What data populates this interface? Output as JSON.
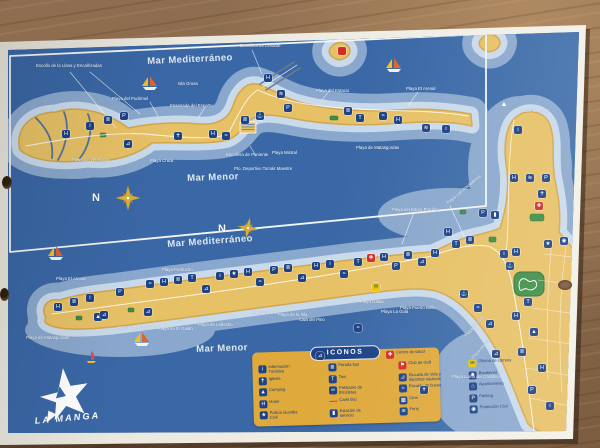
{
  "map": {
    "logo_text": "LA MANGA",
    "legend_title": "ICONOS",
    "sea_labels": [
      {
        "text": "Mar Mediterráneo",
        "x": 147,
        "y": 56,
        "size": 9.5,
        "rot": -2.5
      },
      {
        "text": "Mar Menor",
        "x": 187,
        "y": 173,
        "size": 9.5,
        "rot": -2
      },
      {
        "text": "Mar Mediterráneo",
        "x": 167,
        "y": 239,
        "size": 9.5,
        "rot": -4
      },
      {
        "text": "Mar Menor",
        "x": 196,
        "y": 344,
        "size": 9.5,
        "rot": -2
      }
    ],
    "place_labels": [
      {
        "text": "N",
        "x": 92,
        "y": 192,
        "size": 11,
        "bold": true
      },
      {
        "text": "N",
        "x": 218,
        "y": 223,
        "size": 11,
        "bold": true
      },
      {
        "text": "Escollo de la Llana y Encañizadas",
        "x": 36,
        "y": 64
      },
      {
        "text": "Escollera de Levante",
        "x": 240,
        "y": 44
      },
      {
        "text": "Isla Grosa",
        "x": 178,
        "y": 82
      },
      {
        "text": "Playa del Pudrimel",
        "x": 112,
        "y": 97
      },
      {
        "text": "Ensenada del Esparto",
        "x": 170,
        "y": 104
      },
      {
        "text": "Playa del Estacio",
        "x": 316,
        "y": 89
      },
      {
        "text": "Playa El Arenal",
        "x": 406,
        "y": 87
      },
      {
        "text": "Playa de Veneciola",
        "x": 72,
        "y": 158
      },
      {
        "text": "Playa Chica",
        "x": 150,
        "y": 159
      },
      {
        "text": "Escollera de Poniente",
        "x": 226,
        "y": 153
      },
      {
        "text": "Pto. Deportivo Tomás Maestre",
        "x": 234,
        "y": 167
      },
      {
        "text": "Playa Mistral",
        "x": 272,
        "y": 151
      },
      {
        "text": "Playa de Matasgordas",
        "x": 356,
        "y": 146
      },
      {
        "text": "Cabo de Palos",
        "x": 521,
        "y": 109
      },
      {
        "text": "Playa del Barco Perdido",
        "x": 392,
        "y": 208
      },
      {
        "text": "Playa Las Amoladeras",
        "x": 446,
        "y": 202,
        "rot": -40
      },
      {
        "text": "Playa Pedrucho",
        "x": 162,
        "y": 268
      },
      {
        "text": "Playa El Arenal",
        "x": 56,
        "y": 277
      },
      {
        "text": "Playa El Pedruchillo",
        "x": 118,
        "y": 326
      },
      {
        "text": "Playa de Matasgordas",
        "x": 26,
        "y": 336
      },
      {
        "text": "Playa de El Galán",
        "x": 158,
        "y": 327
      },
      {
        "text": "Playa de Lebeche",
        "x": 198,
        "y": 323
      },
      {
        "text": "Playa Aliseos",
        "x": 252,
        "y": 311
      },
      {
        "text": "Playa de la Isla",
        "x": 278,
        "y": 313
      },
      {
        "text": "Cala del Pino",
        "x": 299,
        "y": 318
      },
      {
        "text": "Playa Galúa",
        "x": 360,
        "y": 300
      },
      {
        "text": "Playa La Gola",
        "x": 381,
        "y": 310
      },
      {
        "text": "Playa Puerto Bello",
        "x": 400,
        "y": 306
      },
      {
        "text": "Playa Paraíso",
        "x": 464,
        "y": 335,
        "rot": -48
      },
      {
        "text": "Playa Honda",
        "x": 471,
        "y": 357,
        "rot": -48
      },
      {
        "text": "Playa Loma del Castillico",
        "x": 452,
        "y": 375
      }
    ],
    "icons": [
      {
        "name": "hotel",
        "glyph": "H",
        "x": 62,
        "y": 130
      },
      {
        "name": "tourist-info",
        "glyph": "i",
        "x": 86,
        "y": 122
      },
      {
        "name": "bus-stop",
        "glyph": "≣",
        "x": 104,
        "y": 116
      },
      {
        "name": "parking",
        "glyph": "P",
        "x": 120,
        "y": 112
      },
      {
        "name": "sailing-school",
        "glyph": "⊿",
        "x": 124,
        "y": 140
      },
      {
        "name": "church",
        "glyph": "✝",
        "x": 174,
        "y": 132
      },
      {
        "name": "hotel",
        "glyph": "H",
        "x": 209,
        "y": 130
      },
      {
        "name": "diving-school",
        "glyph": "≈",
        "x": 222,
        "y": 132
      },
      {
        "name": "bus-stop",
        "glyph": "≣",
        "x": 241,
        "y": 116
      },
      {
        "name": "marina",
        "glyph": "⚓",
        "x": 256,
        "y": 112
      },
      {
        "name": "hotel",
        "glyph": "H",
        "x": 264,
        "y": 74
      },
      {
        "name": "ferry",
        "glyph": "≋",
        "x": 277,
        "y": 90
      },
      {
        "name": "parking",
        "glyph": "P",
        "x": 284,
        "y": 104
      },
      {
        "name": "bus-stop",
        "glyph": "≣",
        "x": 344,
        "y": 107
      },
      {
        "name": "taxi",
        "glyph": "T",
        "x": 356,
        "y": 114
      },
      {
        "name": "diving-school",
        "glyph": "≈",
        "x": 379,
        "y": 112
      },
      {
        "name": "hotel",
        "glyph": "H",
        "x": 394,
        "y": 116
      },
      {
        "name": "ferry",
        "glyph": "≋",
        "x": 422,
        "y": 124
      },
      {
        "name": "tourist-info",
        "glyph": "i",
        "x": 442,
        "y": 125
      },
      {
        "name": "isla-grosa-marker",
        "glyph": "",
        "x": 338,
        "y": 47,
        "bg": "#d22b2b"
      },
      {
        "name": "hotel",
        "glyph": "H",
        "x": 54,
        "y": 303
      },
      {
        "name": "bus-stop",
        "glyph": "≣",
        "x": 70,
        "y": 298
      },
      {
        "name": "tourist-info",
        "glyph": "i",
        "x": 86,
        "y": 294
      },
      {
        "name": "camping",
        "glyph": "▲",
        "x": 94,
        "y": 313
      },
      {
        "name": "parking",
        "glyph": "P",
        "x": 116,
        "y": 288
      },
      {
        "name": "sailing-school",
        "glyph": "⊿",
        "x": 100,
        "y": 311
      },
      {
        "name": "sailing-school",
        "glyph": "⊿",
        "x": 144,
        "y": 308
      },
      {
        "name": "diving-school",
        "glyph": "≈",
        "x": 146,
        "y": 280
      },
      {
        "name": "hotel",
        "glyph": "H",
        "x": 160,
        "y": 278
      },
      {
        "name": "bus-stop",
        "glyph": "≣",
        "x": 174,
        "y": 276
      },
      {
        "name": "taxi",
        "glyph": "T",
        "x": 188,
        "y": 274
      },
      {
        "name": "sailing-school",
        "glyph": "⊿",
        "x": 202,
        "y": 285
      },
      {
        "name": "tourist-info",
        "glyph": "i",
        "x": 216,
        "y": 272
      },
      {
        "name": "police",
        "glyph": "★",
        "x": 230,
        "y": 270
      },
      {
        "name": "hotel",
        "glyph": "H",
        "x": 244,
        "y": 268
      },
      {
        "name": "diving-school",
        "glyph": "≈",
        "x": 256,
        "y": 278
      },
      {
        "name": "parking",
        "glyph": "P",
        "x": 270,
        "y": 266
      },
      {
        "name": "bus-stop",
        "glyph": "≣",
        "x": 284,
        "y": 264
      },
      {
        "name": "sailing-school",
        "glyph": "⊿",
        "x": 298,
        "y": 274
      },
      {
        "name": "hotel",
        "glyph": "H",
        "x": 312,
        "y": 262
      },
      {
        "name": "tourist-info",
        "glyph": "i",
        "x": 326,
        "y": 260
      },
      {
        "name": "diving-school",
        "glyph": "≈",
        "x": 340,
        "y": 270
      },
      {
        "name": "taxi",
        "glyph": "T",
        "x": 354,
        "y": 258
      },
      {
        "name": "health-centre",
        "glyph": "✚",
        "x": 367,
        "y": 254,
        "bg": "#d22b2b"
      },
      {
        "name": "hotel",
        "glyph": "H",
        "x": 380,
        "y": 253
      },
      {
        "name": "post-office",
        "glyph": "✉",
        "x": 372,
        "y": 283,
        "bg": "#e8c400",
        "fg": "#1d4285"
      },
      {
        "name": "parking",
        "glyph": "P",
        "x": 392,
        "y": 262
      },
      {
        "name": "bus-stop",
        "glyph": "≣",
        "x": 404,
        "y": 251
      },
      {
        "name": "sailing-school",
        "glyph": "⊿",
        "x": 418,
        "y": 258
      },
      {
        "name": "hotel",
        "glyph": "H",
        "x": 431,
        "y": 249
      },
      {
        "name": "windsurf-zone",
        "glyph": "⊿",
        "x": 316,
        "y": 352
      },
      {
        "name": "diving-spot",
        "glyph": "≈",
        "x": 354,
        "y": 324
      },
      {
        "name": "church",
        "glyph": "✝",
        "x": 420,
        "y": 386
      },
      {
        "name": "church",
        "glyph": "✝",
        "x": 538,
        "y": 190
      },
      {
        "name": "health-centre",
        "glyph": "✚",
        "x": 535,
        "y": 202,
        "bg": "#d22b2b"
      },
      {
        "name": "parking",
        "glyph": "P",
        "x": 479,
        "y": 209
      },
      {
        "name": "fuel-station",
        "glyph": "▮",
        "x": 491,
        "y": 211
      },
      {
        "name": "hotel",
        "glyph": "H",
        "x": 444,
        "y": 228
      },
      {
        "name": "taxi",
        "glyph": "T",
        "x": 452,
        "y": 240
      },
      {
        "name": "bus-stop",
        "glyph": "≣",
        "x": 466,
        "y": 236
      },
      {
        "name": "police",
        "glyph": "★",
        "x": 544,
        "y": 240
      },
      {
        "name": "civil-protection",
        "glyph": "◉",
        "x": 560,
        "y": 237
      },
      {
        "name": "tourist-info",
        "glyph": "i",
        "x": 500,
        "y": 250
      },
      {
        "name": "hotel",
        "glyph": "H",
        "x": 512,
        "y": 248
      },
      {
        "name": "marina",
        "glyph": "⚓",
        "x": 506,
        "y": 262
      },
      {
        "name": "lighthouse",
        "glyph": "▲",
        "x": 500,
        "y": 101,
        "bg": "none"
      },
      {
        "name": "tourist-info",
        "glyph": "i",
        "x": 514,
        "y": 126
      },
      {
        "name": "hotel",
        "glyph": "H",
        "x": 510,
        "y": 174
      },
      {
        "name": "ferry",
        "glyph": "≋",
        "x": 526,
        "y": 174
      },
      {
        "name": "parking",
        "glyph": "P",
        "x": 542,
        "y": 174
      },
      {
        "name": "taxi",
        "glyph": "T",
        "x": 524,
        "y": 298
      },
      {
        "name": "hotel",
        "glyph": "H",
        "x": 512,
        "y": 312
      },
      {
        "name": "camping",
        "glyph": "▲",
        "x": 530,
        "y": 328
      },
      {
        "name": "bus-stop",
        "glyph": "≣",
        "x": 518,
        "y": 348
      },
      {
        "name": "hotel",
        "glyph": "H",
        "x": 538,
        "y": 364
      },
      {
        "name": "parking",
        "glyph": "P",
        "x": 528,
        "y": 386
      },
      {
        "name": "tourist-info",
        "glyph": "i",
        "x": 546,
        "y": 402
      },
      {
        "name": "sailing-school",
        "glyph": "⊿",
        "x": 486,
        "y": 320
      },
      {
        "name": "diving-school",
        "glyph": "≈",
        "x": 474,
        "y": 304
      },
      {
        "name": "marina",
        "glyph": "⚓",
        "x": 460,
        "y": 290
      },
      {
        "name": "sailing-school",
        "glyph": "⊿",
        "x": 492,
        "y": 350
      }
    ],
    "boats": [
      {
        "type": "sailboat",
        "x": 140,
        "y": 76
      },
      {
        "type": "sailboat",
        "x": 384,
        "y": 58
      },
      {
        "type": "sailboat",
        "x": 46,
        "y": 246
      },
      {
        "type": "sailboat",
        "x": 132,
        "y": 332
      },
      {
        "type": "windsurfer",
        "x": 84,
        "y": 350
      }
    ]
  },
  "legend": {
    "title": "ICONOS",
    "header_item": {
      "label": "Centro de salud",
      "icon": "health-centre",
      "glyph": "✚",
      "bg": "#d22b2b",
      "fg": "#ffffff"
    },
    "columns": [
      {
        "items": [
          {
            "label": "Información Turística",
            "icon": "tourist-info",
            "glyph": "i"
          },
          {
            "label": "Iglesia",
            "icon": "church",
            "glyph": "✝"
          },
          {
            "label": "Camping",
            "icon": "camping",
            "glyph": "▲"
          },
          {
            "label": "Hotel",
            "icon": "hotel",
            "glyph": "H"
          },
          {
            "label": "Policía Guardia Civil",
            "icon": "police",
            "glyph": "★"
          }
        ]
      },
      {
        "items": [
          {
            "label": "Parada bus",
            "icon": "bus-stop",
            "glyph": "≣"
          },
          {
            "label": "Taxi",
            "icon": "taxi",
            "glyph": "T"
          },
          {
            "label": "Préstamo de Bicicletas",
            "icon": "bike-rental",
            "glyph": "∞"
          },
          {
            "label": "Carril Bici",
            "icon": "bike-lane",
            "glyph": "—",
            "bg": "none",
            "fg": "#d22b2b"
          },
          {
            "label": "Estación de servicio",
            "icon": "fuel-station",
            "glyph": "▮"
          }
        ]
      },
      {
        "items": [
          {
            "label": "Club de Golf",
            "icon": "golf-club",
            "glyph": "⚑",
            "bg": "#d22b2b"
          },
          {
            "label": "Escuela de Vela y deportes náuticos",
            "icon": "sailing-school",
            "glyph": "⊿"
          },
          {
            "label": "Escuela de buceo",
            "icon": "diving-school",
            "glyph": "≈"
          },
          {
            "label": "Cine",
            "icon": "cinema",
            "glyph": "▦"
          },
          {
            "label": "Ferry",
            "icon": "ferry",
            "glyph": "≋"
          }
        ]
      },
      {
        "items": [
          {
            "label": "Oficina de correos",
            "icon": "post-office",
            "glyph": "✉",
            "bg": "#e8c400",
            "fg": "#1d4285"
          },
          {
            "label": "Bomberos",
            "icon": "fire-station",
            "glyph": "✹"
          },
          {
            "label": "Ayuntamiento",
            "icon": "town-hall",
            "glyph": "⌂"
          },
          {
            "label": "Parking",
            "icon": "parking",
            "glyph": "P"
          },
          {
            "label": "Protección Civil",
            "icon": "civil-protection",
            "glyph": "◉"
          }
        ]
      }
    ]
  }
}
